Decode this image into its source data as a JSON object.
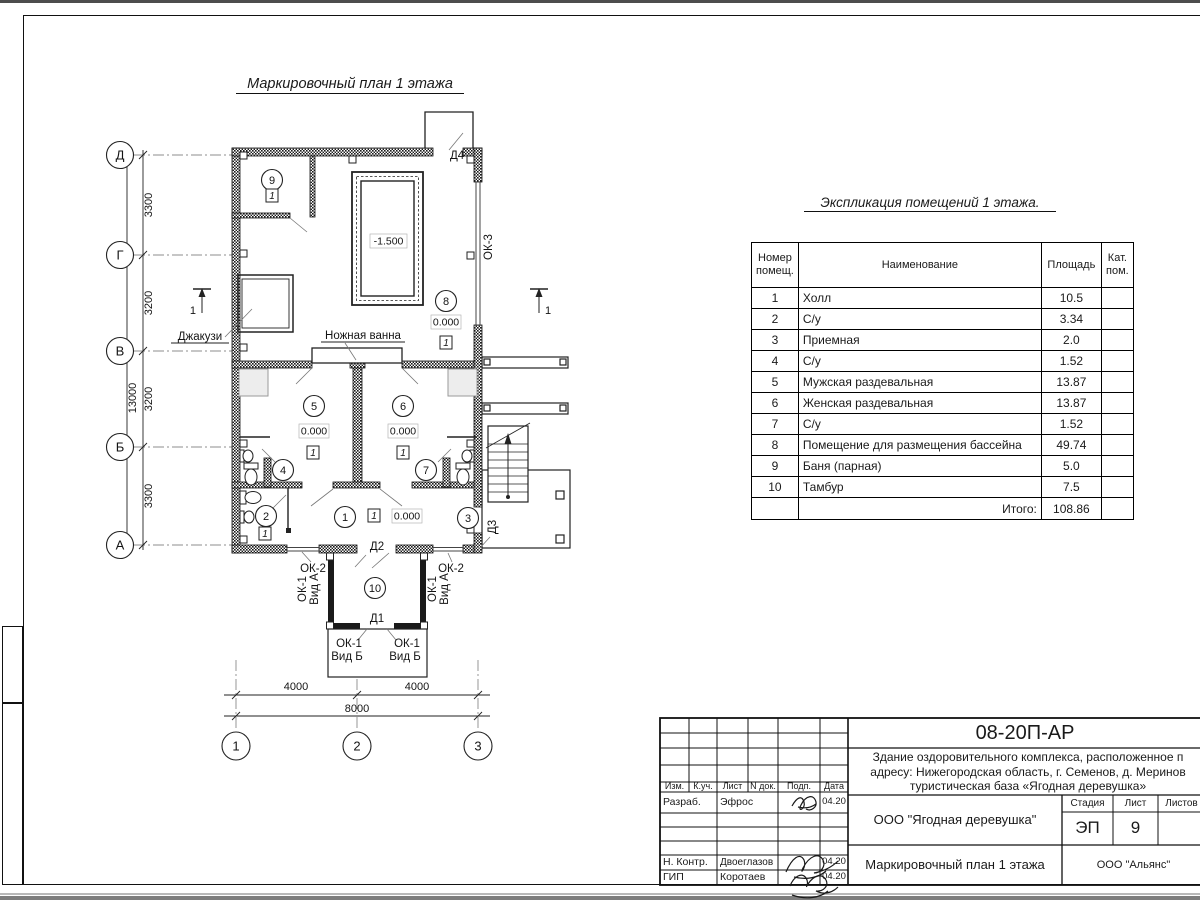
{
  "sheet": {
    "plan_title": "Маркировочный план 1 этажа",
    "section_mark": "1"
  },
  "plan": {
    "axis_rows": [
      "Д",
      "Г",
      "В",
      "Б",
      "А"
    ],
    "axis_cols": [
      "1",
      "2",
      "3"
    ],
    "dims_left": [
      "3300",
      "3200",
      "3200",
      "3300"
    ],
    "dim_left_total": "13000",
    "dims_bottom": [
      "4000",
      "4000"
    ],
    "dim_bottom_total": "8000",
    "room_tags": [
      "1",
      "2",
      "3",
      "4",
      "5",
      "6",
      "7",
      "8",
      "9",
      "10"
    ],
    "elevation_zero": "0.000",
    "elevation_pool": "-1.500",
    "floor_type_flag": "1",
    "labels": {
      "jacuzzi": "Джакузи",
      "foot_bath": "Ножная ванна",
      "door_d1": "Д1",
      "door_d2": "Д2",
      "door_d3": "Д3",
      "door_d4": "Д4",
      "window_ok1": "ОК-1",
      "window_ok1_view_a": "Вид А",
      "window_ok1_view_b": "Вид Б",
      "window_ok2": "ОК-2",
      "window_ok3": "ОК-3"
    }
  },
  "explication": {
    "title": "Экспликация помещений 1 этажа.",
    "headers": {
      "number": "Номер\nпомещ.",
      "name": "Наименование",
      "area": "Площадь",
      "cat": "Кат.\nпом."
    },
    "rows": [
      {
        "n": "1",
        "name": "Холл",
        "area": "10.5"
      },
      {
        "n": "2",
        "name": "С/у",
        "area": "3.34"
      },
      {
        "n": "3",
        "name": "Приемная",
        "area": "2.0"
      },
      {
        "n": "4",
        "name": "С/у",
        "area": "1.52"
      },
      {
        "n": "5",
        "name": "Мужская раздевальная",
        "area": "13.87"
      },
      {
        "n": "6",
        "name": "Женская раздевальная",
        "area": "13.87"
      },
      {
        "n": "7",
        "name": "С/у",
        "area": "1.52"
      },
      {
        "n": "8",
        "name": "Помещение для размещения бассейна",
        "area": "49.74"
      },
      {
        "n": "9",
        "name": "Баня (парная)",
        "area": "5.0"
      },
      {
        "n": "10",
        "name": "Тамбур",
        "area": "7.5"
      }
    ],
    "total_label": "Итого:",
    "total_value": "108.86"
  },
  "titleblock": {
    "doc_number": "08-20П-АР",
    "project_line1": "Здание оздоровительного комплекса, расположенное п",
    "project_line2": "адресу: Нижегородская область, г. Семенов, д. Меринов",
    "project_line3": "туристическая база «Ягодная деревушка»",
    "company": "ООО \"Ягодная деревушка\"",
    "stage_label": "Стадия",
    "sheet_label": "Лист",
    "sheets_label": "Листов",
    "stage_value": "ЭП",
    "sheet_value": "9",
    "plan_title": "Маркировочный план 1 этажа",
    "contractor": "ООО \"Альянс\"",
    "cols": {
      "izm": "Изм.",
      "kuch": "К.уч.",
      "list": "Лист",
      "ndoc": "N док.",
      "podp": "Подп.",
      "data": "Дата"
    },
    "rows": {
      "razrab": {
        "role": "Разраб.",
        "name": "Эфрос",
        "date": "04.20"
      },
      "nkontr": {
        "role": "Н. Контр.",
        "name": "Двоеглазов",
        "date": "04.20"
      },
      "gip": {
        "role": "ГИП",
        "name": "Коротаев",
        "date": "04.20"
      }
    }
  }
}
